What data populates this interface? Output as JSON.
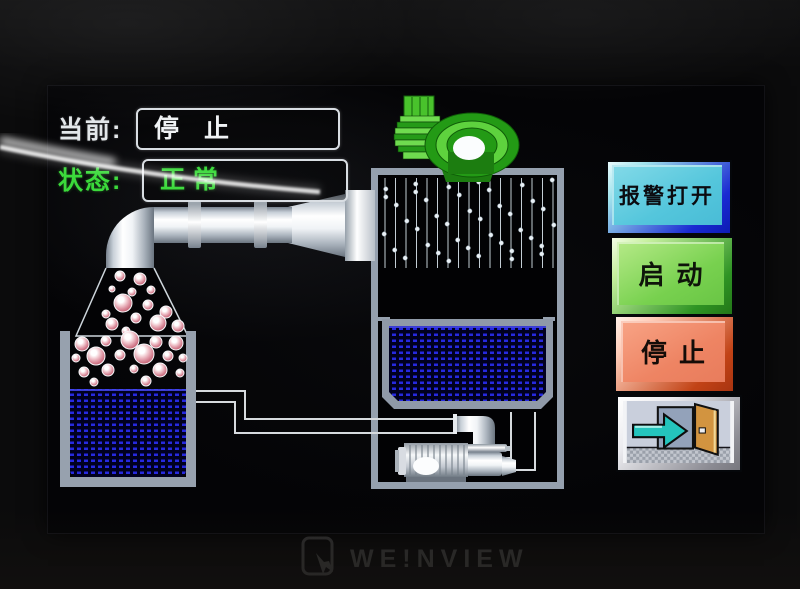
{
  "device": {
    "brand_text": "WE!NVIEW"
  },
  "hmi": {
    "current_label": "当前:",
    "current_value": "停　止",
    "status_label": "状态:",
    "status_value": "正常"
  },
  "buttons": {
    "alarm": {
      "label": "报警打开"
    },
    "start": {
      "label": "启动"
    },
    "stop": {
      "label": "停止"
    },
    "exit": {
      "icon": "exit-door-arrow-icon"
    }
  },
  "icons": {
    "blower": "blower-fan-icon",
    "pump": "pump-icon",
    "brand": "touch-hand-icon"
  },
  "colors": {
    "status_green": "#3bda3b",
    "value_white": "#f0f3f5",
    "liquid_blue": "#2629e0",
    "alarm_fill": "#54c6dc",
    "alarm_edge": "#1a2ad2",
    "start_fill": "#78d14f",
    "start_edge": "#2f9424",
    "stop_fill": "#ee8463",
    "stop_edge": "#c24316",
    "fan_green": "#2ba01c",
    "tank_gray": "#95a0ae"
  }
}
